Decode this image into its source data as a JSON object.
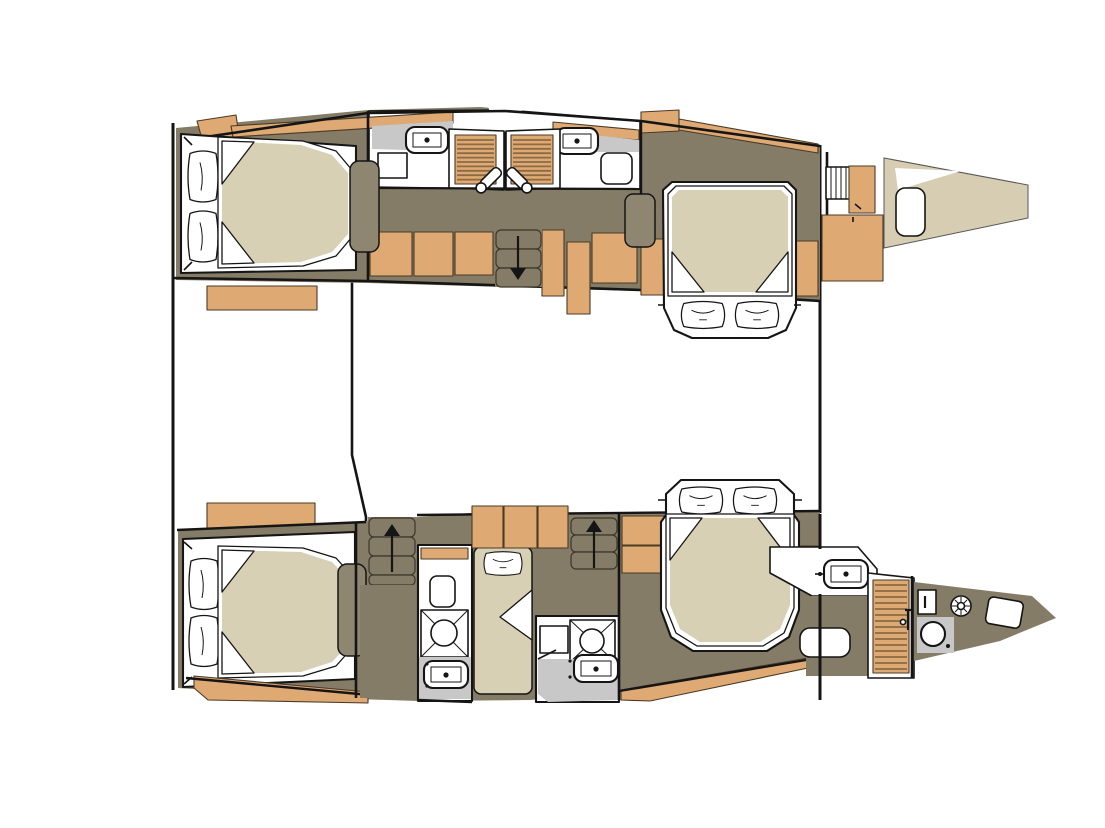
{
  "canvas": {
    "width": 1105,
    "height": 828
  },
  "palette": {
    "white": "#ffffff",
    "ink": "#151515",
    "hull_line": "#8d8d8d",
    "wood": "#dfa973",
    "wood_stripe": "#8a6b45",
    "floor": "#857c67",
    "floor_light": "#8f8672",
    "mattress": "#d8d0b5",
    "foredeck": "#d6cdb2",
    "counter": "#c8c8c8"
  },
  "fixtures": {
    "double_berths": 4,
    "single_berths": 1,
    "pillows": 9,
    "sinks": 5,
    "shower_trays": 2,
    "shower_drains": 1,
    "toilets": 2,
    "louvered_lockers": 3,
    "companionway_stairs": 3,
    "shower_handsets": 2,
    "deck_ladders": 1,
    "deck_hatches": 2
  }
}
